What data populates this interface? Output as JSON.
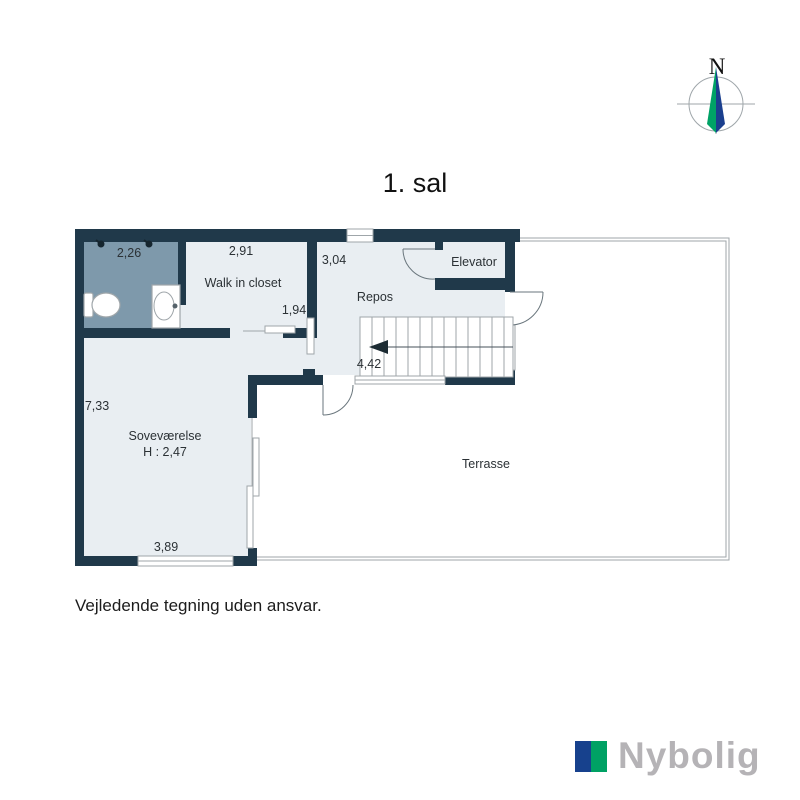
{
  "page": {
    "title": "1. sal",
    "disclaimer": "Vejledende tegning uden ansvar."
  },
  "compass": {
    "north_label": "N"
  },
  "brand": {
    "name": "Nybolig"
  },
  "plan": {
    "rooms": {
      "bathroom": {
        "dim_top": "2,26"
      },
      "closet": {
        "label": "Walk in closet",
        "dim_top": "2,91",
        "dim_door": "1,94"
      },
      "repos": {
        "label": "Repos",
        "dim_top": "3,04"
      },
      "elevator": {
        "label": "Elevator"
      },
      "bedroom": {
        "label": "Soveværelse",
        "ceiling_height": "H : 2,47",
        "dim_left": "7,33",
        "dim_bottom": "3,89"
      },
      "stairs": {
        "dim": "4,42"
      },
      "terrace": {
        "label": "Terrasse"
      }
    }
  },
  "colors": {
    "wall": "#20394a",
    "floor": "#e9eef2",
    "bath": "#7e99ab",
    "outline": "#9fa6aa",
    "doorline": "#6a767d",
    "brandblue": "#17418d",
    "brandgreen": "#00a164",
    "brandgray": "#b5b3b6",
    "compassgreen": "#00a266",
    "compassblue": "#1b3f8e"
  }
}
